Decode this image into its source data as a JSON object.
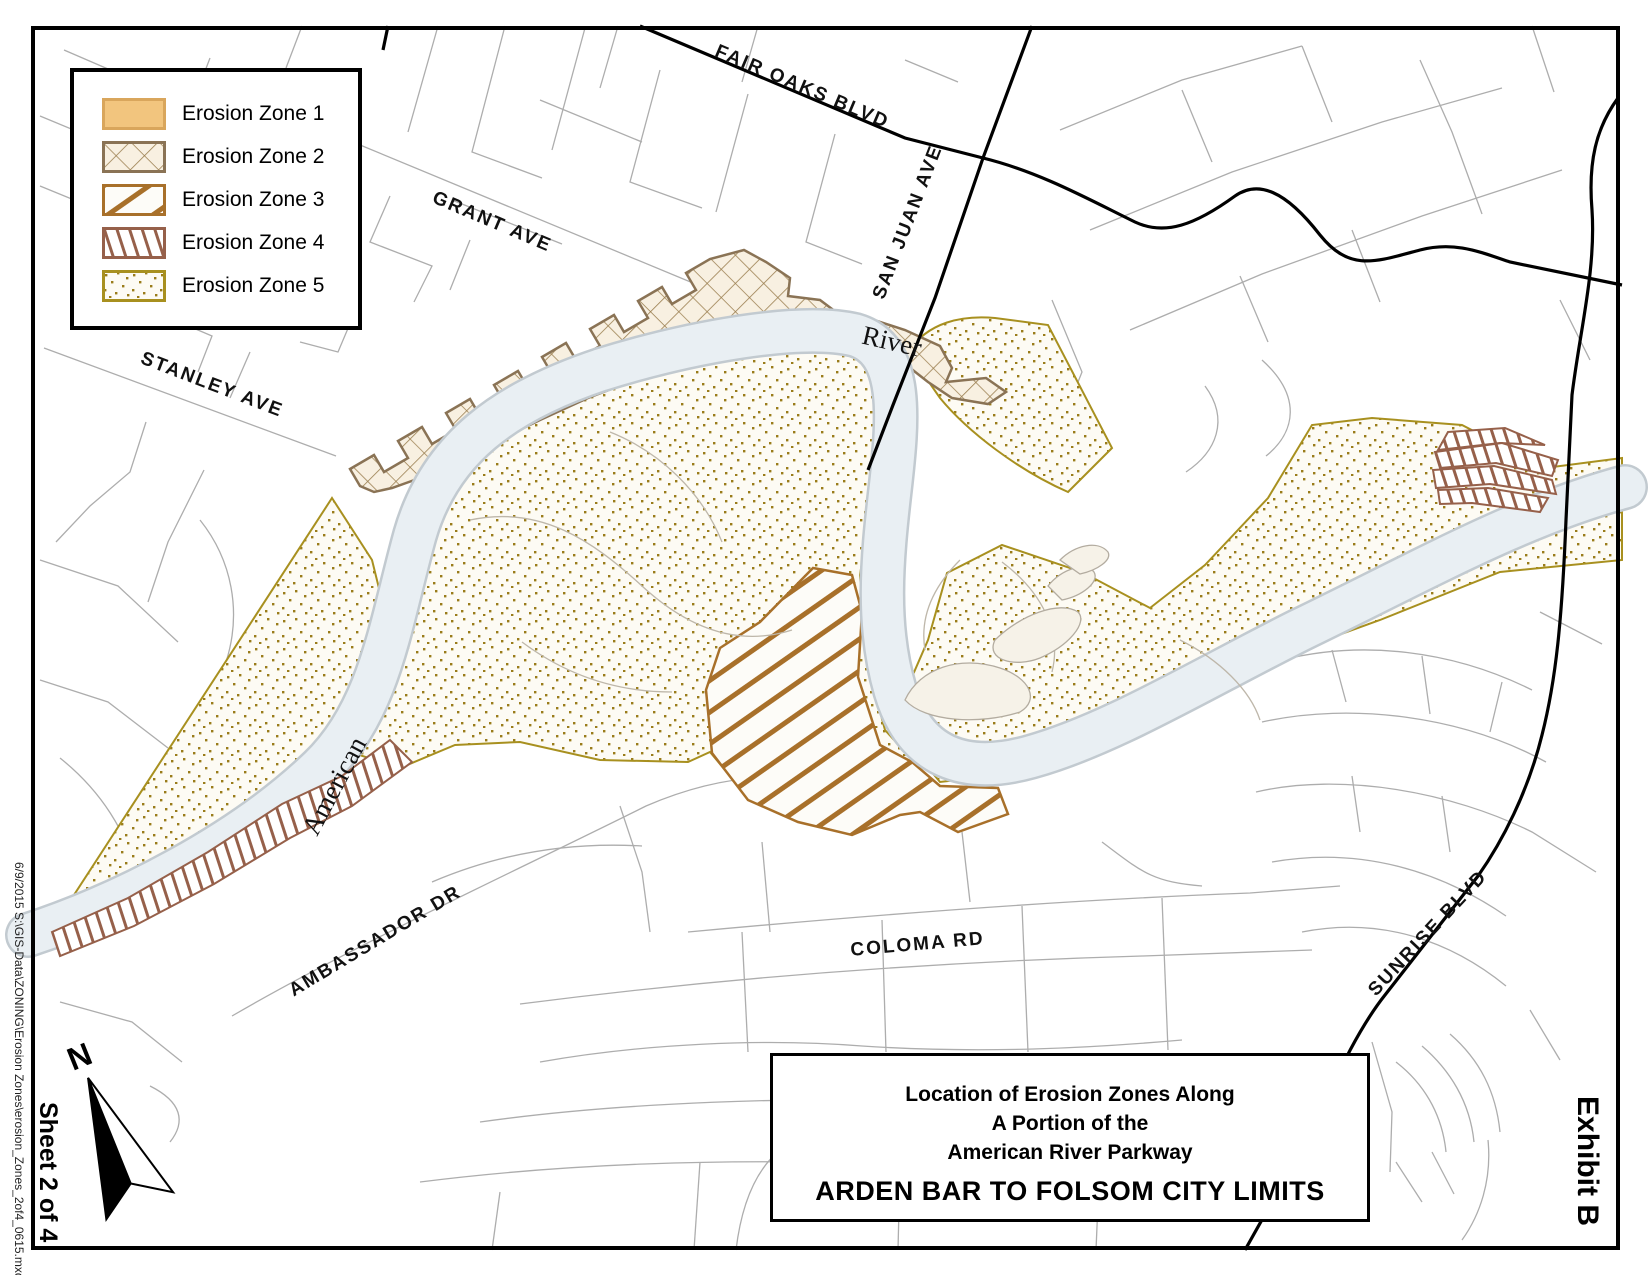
{
  "legend": {
    "items": [
      {
        "label": "Erosion Zone 1",
        "pattern": "solid-tan"
      },
      {
        "label": "Erosion Zone 2",
        "pattern": "crosshatch"
      },
      {
        "label": "Erosion Zone 3",
        "pattern": "diagonal-stripes"
      },
      {
        "label": "Erosion Zone 4",
        "pattern": "vertical-bars"
      },
      {
        "label": "Erosion Zone 5",
        "pattern": "dots"
      }
    ]
  },
  "map_labels": {
    "streets": [
      {
        "text": "FAIR OAKS BLVD"
      },
      {
        "text": "SAN JUAN AVE"
      },
      {
        "text": "GRANT AVE"
      },
      {
        "text": "STANLEY AVE"
      },
      {
        "text": "AMBASSADOR DR"
      },
      {
        "text": "COLOMA RD"
      },
      {
        "text": "SUNRISE BLVD"
      }
    ],
    "river": {
      "word1": "American",
      "word2": "River"
    }
  },
  "title_block": {
    "line1": "Location of Erosion Zones Along",
    "line2": "A Portion of the",
    "line3": "American River Parkway",
    "line4": "ARDEN BAR TO FOLSOM CITY LIMITS"
  },
  "margins": {
    "sheet": "Sheet 2 of 4",
    "exhibit": "Exhibit B",
    "filepath": "6/9/2015 S:\\GIS-Data\\ZONING\\Erosion Zones\\erosion_Zones_2of4_0615.mxd",
    "north": "N"
  },
  "colors": {
    "zone1_fill": "#F2C57E",
    "zone1_border": "#D9A65C",
    "zone2_fill": "#F8F0E1",
    "zone2_line": "#9B7F50",
    "zone2_border": "#8A7355",
    "zone3_stripe": "#A8702A",
    "zone4_stripe": "#96604A",
    "zone5_dot": "#9A7C1A",
    "zone5_border": "#A8901F",
    "river_fill": "#E9EFF3",
    "river_edge": "#C2CAD0",
    "street_gray": "#ADADAD",
    "road_black": "#000000"
  }
}
